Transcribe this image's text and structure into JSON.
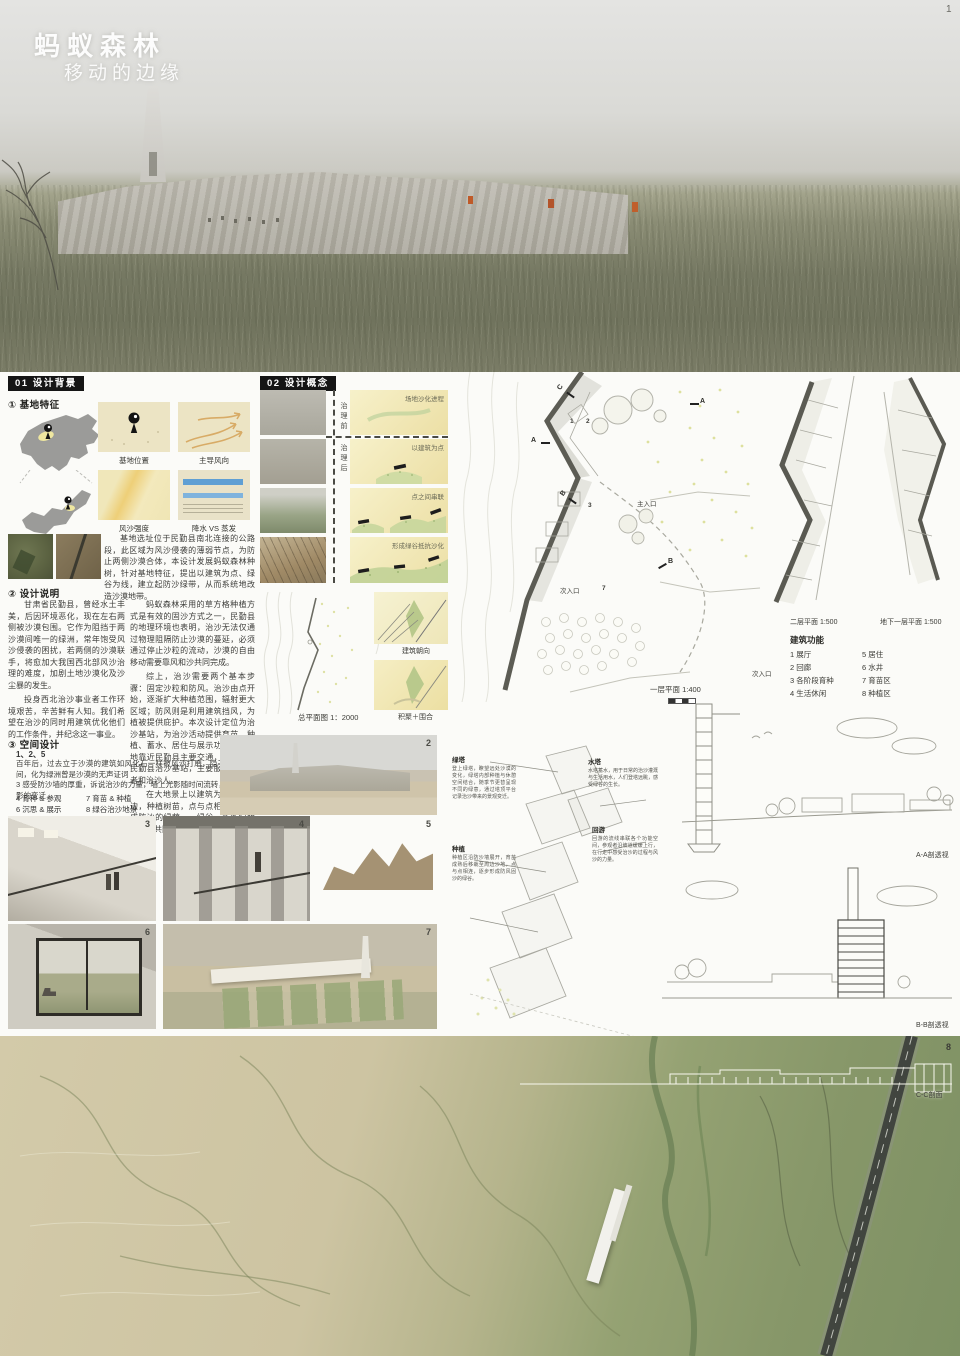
{
  "hero": {
    "title": "蚂蚁森林",
    "subtitle": "移动的边缘",
    "page_number": "1"
  },
  "bg01": {
    "header": "01 设计背景",
    "site": {
      "heading": "① 基地特征",
      "caps": [
        "基地位置",
        "主导风向",
        "风沙强度",
        "降水 VS 蒸发"
      ],
      "intro": "基地选址位于民勤县南北连接的公路段，此区域为风沙侵袭的薄弱节点，为防止两侧沙漠合体，本设计发展蚂蚁森林种树，针对基地特征，提出以建筑为点、绿谷为线，建立起防沙绿带，从而系统地改造沙漠地带。"
    },
    "notes": {
      "heading": "② 设计说明",
      "lp1": "甘肃省民勤县，曾经水土丰美，后因环境恶化，现在左右两侧被沙漠包围。它作为阻挡于两沙漠间唯一的绿洲，常年饱受风沙侵袭的困扰，若两侧的沙漠联手，将愈加大我国西北部风沙治理的难度，加剧土地沙漠化及沙尘暴的发生。",
      "lp2": "投身西北治沙事业者工作环境艰苦，辛苦鲜有人知。我们希望在治沙的同时用建筑优化他们的工作条件，并纪念这一事业。",
      "rp1": "蚂蚁森林采用的草方格种植方式是有效的固沙方式之一，民勤县的地理环境也表明，治沙无法仅通过物理阻隔防止沙漠的蔓延，必须通过停止沙粒的流动，沙漠的自由移动需要靠风和沙共同完成。",
      "rp2": "综上，治沙需要两个基本步骤：固定沙粒和防风。治沙由点开始，逐渐扩大种植范围，辐射更大区域；防风则是利用建筑挡风，为植被提供庇护。本次设计定位为治沙基站，为治沙活动提供育苗、种植、蓄水、居住与展示功能，因基地靠近民勤县主要交通，可以作为民勤县治沙基站，主要服务于参观者和治沙人。",
      "rp3": "在大地景上以建筑为点辐射周边，种植树苗，点与点相连接，形成防沙的绿荫——绿谷，多条绿荫配合，共同恢复沙漠绿意。"
    },
    "space": {
      "heading": "③ 空间设计",
      "line1": "1、2、5",
      "p1": "百年后，过去立于沙漠的建筑如风化石一样被风沙打磨，隐于绿树青草间，化为绿洲曾是沙漠的无声证词",
      "p2": "3 感受防沙墙的厚重，诉说治沙的力量，墙上光影随时间流转，犹见上树影的变迁",
      "r1a": "4 育种 & 参观",
      "r1b": "7 育苗 & 种植",
      "r2a": "6 沉思 & 展示",
      "r2b": "8 绿谷治沙地景"
    }
  },
  "concept": {
    "header": "02 设计概念",
    "before": "治理前",
    "after": "治理后",
    "steps": [
      "场地沙化进程",
      "以建筑为点",
      "点之间串联",
      "形成绿谷抵抗沙化"
    ],
    "siteplan_caption": "总平面图 1：2000",
    "orientation": "建筑朝向",
    "enclosure": "积聚＋围合"
  },
  "plans": {
    "first": "一层平面 1:400",
    "second": "二层平面 1:500",
    "basement": "地下一层平面 1:500",
    "main_entrance": "主入口",
    "secondary_entrance": "次入口",
    "markers": {
      "a": "A",
      "b": "B",
      "c": "C"
    },
    "nums": [
      "1",
      "2",
      "3",
      "7"
    ],
    "functions": {
      "title": "建筑功能",
      "items_left": [
        "1 展厅",
        "2 回廊",
        "3 各阶段育种",
        "4 生活休闲"
      ],
      "items_right": [
        "5 居住",
        "6 水井",
        "7 育苗区",
        "8 种植区"
      ]
    }
  },
  "axon": {
    "notes": [
      {
        "title": "绿塔",
        "text": "登上绿塔，瞭望远处沙漠的变化，绿塔内部种植与休憩空间结合，随季节更替呈现不同的绿意，通过塔顶平台记录治沙带来的景观变迁。"
      },
      {
        "title": "水塔",
        "text": "水塔蓄水，用于日常的治沙灌溉与生活用水，人们登塔远眺，感受绿谷的生长。"
      },
      {
        "title": "回游",
        "text": "回游的流线串联各个功能空间，参观者沿坡道缓缓上行，在行走中感受治沙的过程与风沙的力量。"
      },
      {
        "title": "种植",
        "text": "种植区沿防沙墙展开，育苗成熟后移栽至周边沙地，点与点相连，逐步形成防风固沙的绿谷。"
      }
    ]
  },
  "secviews": {
    "aa": "A-A剖透视",
    "bb": "B-B剖透视",
    "cc": "C-C剖面"
  },
  "photos": {
    "n2": "2",
    "n3": "3",
    "n4": "4",
    "n5": "5",
    "n6": "6",
    "n7": "7",
    "n8": "8"
  }
}
